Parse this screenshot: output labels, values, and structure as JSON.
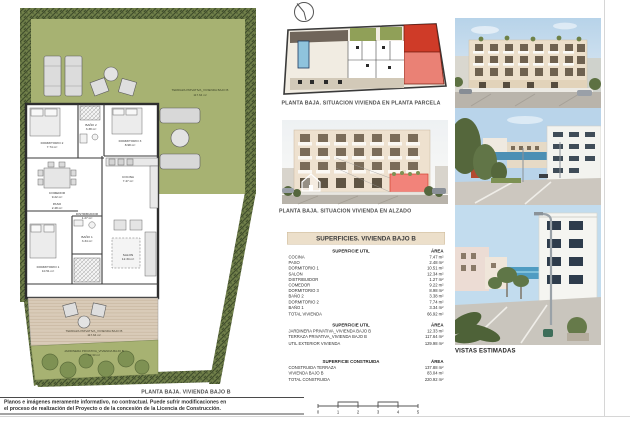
{
  "page": {
    "floor_plan_caption": "PLANTA BAJA. VIVIENDA BAJO B",
    "site_plan_caption": "PLANTA BAJA. SITUACION VIVIENDA EN PLANTA PARCELA",
    "elevation_caption": "PLANTA BAJA. SITUACION VIVIENDA EN ALZADO",
    "photos_caption": "VISTAS ESTIMADAS"
  },
  "floor_plan": {
    "garden_label_line1": "TERRAZA PRIVATIVA_VIVIENDA BAJO B",
    "garden_label_line2": "117.64 m²",
    "deck_label_line1": "TERRAZA PRIVATIVA_VIVIENDA BAJO B",
    "deck_label_line2": "117.64 m²",
    "jardinera_label_line1": "JARDINERA PRIVATIVA_VIVIENDA BAJO B",
    "jardinera_label_line2": "12.33 m²",
    "rooms": [
      {
        "name": "DORMITORIO 2",
        "area": "7.74 m²"
      },
      {
        "name": "BAÑO 2",
        "area": "3.38 m²"
      },
      {
        "name": "DORMITORIO 3",
        "area": "8.98 m²"
      },
      {
        "name": "COMEDOR",
        "area": "9.22 m²"
      },
      {
        "name": "COCINA",
        "area": "7.47 m²"
      },
      {
        "name": "PASO",
        "area": "2.48 m²"
      },
      {
        "name": "DORMITORIO 1",
        "area": "10.51 m²"
      },
      {
        "name": "BAÑO 1",
        "area": "3.34 m²"
      },
      {
        "name": "DISTRIBUIDOR",
        "area": "1.27 m²"
      },
      {
        "name": "SALON",
        "area": "12.34 m²"
      }
    ]
  },
  "surfaces_table": {
    "title": "SUPERFICIES. VIVIENDA BAJO B",
    "sections": [
      {
        "header": "SUPERFICIE UTIL",
        "area_header": "ÁREA",
        "rows": [
          {
            "label": "COCINA",
            "area": "7.47 m²"
          },
          {
            "label": "PASO",
            "area": "2.48 m²"
          },
          {
            "label": "DORMITORIO 1",
            "area": "10.51 m²"
          },
          {
            "label": "SALON",
            "area": "12.34 m²"
          },
          {
            "label": "DISTRIBUIDOR",
            "area": "1.27 m²"
          },
          {
            "label": "COMEDOR",
            "area": "9.22 m²"
          },
          {
            "label": "DORMITORIO 3",
            "area": "8.98 m²"
          },
          {
            "label": "BAÑO 2",
            "area": "3.38 m²"
          },
          {
            "label": "DORMITORIO 2",
            "area": "7.74 m²"
          },
          {
            "label": "BAÑO 1",
            "area": "3.34 m²"
          },
          {
            "label": "TOTAL VIVIENDA",
            "area": "66.92 m²",
            "total": true
          }
        ]
      },
      {
        "header": "SUPERFICIE UTIL",
        "area_header": "ÁREA",
        "rows": [
          {
            "label": "JARDINERA PRIVATIVA_VIVIENDA BAJO B",
            "area": "12.33 m²"
          },
          {
            "label": "TERRAZA PRIVATIVA_VIVIENDA BAJO B",
            "area": "117.64 m²"
          },
          {
            "label": "UTIL EXTERIOR VIVIENDA",
            "area": "129.98 m²",
            "total": true
          }
        ]
      },
      {
        "header": "SUPERFICIE CONSTRUIDA",
        "area_header": "ÁREA",
        "rows": [
          {
            "label": "CONSTRUIDA TERRAZA",
            "area": "137.88 m²"
          },
          {
            "label": "VIVIENDA BAJO B",
            "area": "83.04 m²"
          },
          {
            "label": "TOTAL CONSTRUIDA",
            "area": "220.92 m²",
            "total": true
          }
        ]
      }
    ]
  },
  "footer": {
    "disclaimer_line1": "Planos e imágenes meramente informativo, no contractual. Puede sufrir modificaciones en",
    "disclaimer_line2": "el proceso de realización del Proyecto o de la concesión de la Licencia de Construcción.",
    "scale_labels": [
      "0",
      "1",
      "2",
      "3",
      "4",
      "5"
    ]
  },
  "icons": {
    "compass": "north-compass-icon",
    "house_watermark": "house-icon"
  },
  "colors": {
    "garden_green": "#a7b272",
    "hedge_dark": "#3e4a2a",
    "deck_tan": "#d9cbb8",
    "table_header_bg": "#ecdfca",
    "highlight_red": "#cf3b28",
    "highlight_pink": "#ea8175",
    "pool_blue": "#8fc3dd",
    "sky_blue": "#bcd6ea",
    "sea_blue": "#4f9cc2"
  }
}
